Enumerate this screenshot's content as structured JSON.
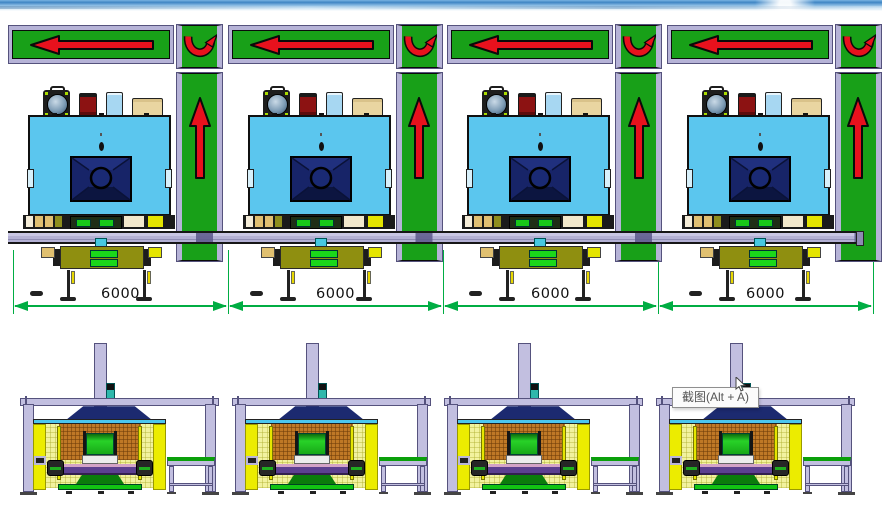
{
  "layout": {
    "top_unit_count": 4,
    "bottom_unit_count": 4
  },
  "dimensions": {
    "values": [
      "6000",
      "6000",
      "6000",
      "6000"
    ],
    "color": "#00ad43"
  },
  "tooltip": {
    "text": "截图(Alt + A)"
  },
  "icons": {
    "equipment": [
      "pump-icon",
      "canister-icon",
      "card-icon",
      "box-icon"
    ],
    "flow": [
      "arrow-left-icon",
      "u-turn-arrow-icon",
      "arrow-up-icon"
    ]
  },
  "colors": {
    "conveyor_green": "#18a018",
    "frame_lavender": "#b6b3d7",
    "arrow_red": "#e8111d",
    "machine_blue": "#5bc6ee",
    "panel_navy": "#172468",
    "enclosure_yellow": "#ecec00",
    "mesh_orange": "#bf7826",
    "gantry_lavender": "#c2bfe0",
    "belt_green_dark": "#0aa00a"
  }
}
